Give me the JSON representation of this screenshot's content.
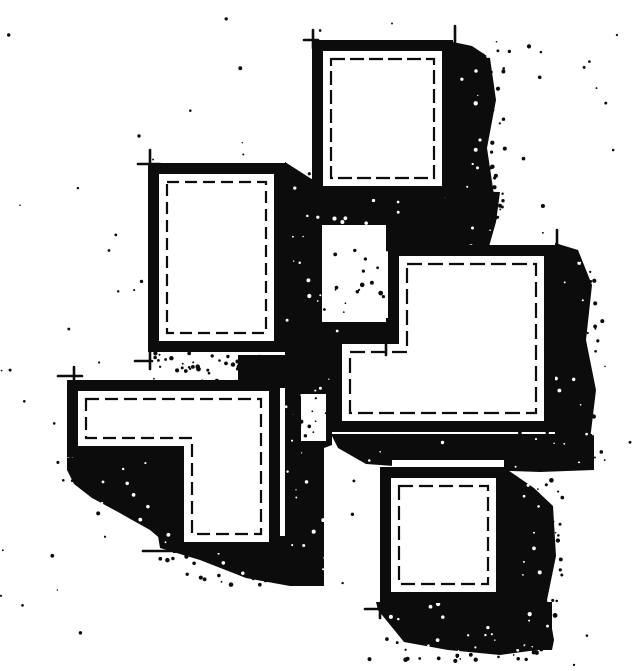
{
  "meta": {
    "description": "Hand-drawn black and white architectural figure-ground sketch: five white rectangular blocks with heavy black outlines, thin broken inner outlines, corner overshoot tick marks, dense black drop shadows cast down and to the right, and stippled dot texture scattered over the paper."
  },
  "canvas": {
    "width": 640,
    "height": 671,
    "paper": "#ffffff",
    "ink": "#0c0c0c"
  },
  "figure": {
    "rooms": [
      {
        "name": "room-top-square",
        "dash": "14 5",
        "outer": [
          [
            312,
            40
          ],
          [
            453,
            40
          ],
          [
            453,
            197
          ],
          [
            312,
            197
          ]
        ],
        "inner": [
          [
            323,
            51
          ],
          [
            442,
            51
          ],
          [
            442,
            186
          ],
          [
            323,
            186
          ]
        ],
        "line": [
          [
            331,
            59
          ],
          [
            434,
            59
          ],
          [
            434,
            178
          ],
          [
            331,
            178
          ]
        ]
      },
      {
        "name": "room-left-rectangle",
        "dash": "12 6",
        "outer": [
          [
            148,
            163
          ],
          [
            285,
            163
          ],
          [
            285,
            352
          ],
          [
            148,
            352
          ]
        ],
        "inner": [
          [
            159,
            174
          ],
          [
            274,
            174
          ],
          [
            274,
            341
          ],
          [
            159,
            341
          ]
        ],
        "line": [
          [
            167,
            182
          ],
          [
            266,
            182
          ],
          [
            266,
            333
          ],
          [
            167,
            333
          ]
        ]
      },
      {
        "name": "room-large-l-block",
        "dash": "15 6",
        "outer": [
          [
            388,
            245
          ],
          [
            555,
            245
          ],
          [
            555,
            432
          ],
          [
            331,
            432
          ],
          [
            331,
            333
          ],
          [
            388,
            333
          ]
        ],
        "inner": [
          [
            399,
            256
          ],
          [
            544,
            256
          ],
          [
            544,
            421
          ],
          [
            342,
            421
          ],
          [
            342,
            344
          ],
          [
            399,
            344
          ]
        ],
        "line": [
          [
            407,
            264
          ],
          [
            536,
            264
          ],
          [
            536,
            413
          ],
          [
            350,
            413
          ],
          [
            350,
            352
          ],
          [
            407,
            352
          ]
        ]
      },
      {
        "name": "room-lower-l-block",
        "dash": "13 6",
        "outer": [
          [
            67,
            380
          ],
          [
            280,
            380
          ],
          [
            280,
            553
          ],
          [
            173,
            553
          ],
          [
            173,
            457
          ],
          [
            67,
            457
          ]
        ],
        "inner": [
          [
            78,
            391
          ],
          [
            269,
            391
          ],
          [
            269,
            542
          ],
          [
            184,
            542
          ],
          [
            184,
            446
          ],
          [
            78,
            446
          ]
        ],
        "line": [
          [
            86,
            399
          ],
          [
            261,
            399
          ],
          [
            261,
            534
          ],
          [
            192,
            534
          ],
          [
            192,
            438
          ],
          [
            86,
            438
          ]
        ]
      },
      {
        "name": "room-bottom-square",
        "dash": "14 6",
        "outer": [
          [
            380,
            467
          ],
          [
            507,
            467
          ],
          [
            507,
            603
          ],
          [
            380,
            603
          ]
        ],
        "inner": [
          [
            391,
            478
          ],
          [
            496,
            478
          ],
          [
            496,
            592
          ],
          [
            391,
            592
          ]
        ],
        "line": [
          [
            399,
            486
          ],
          [
            488,
            486
          ],
          [
            488,
            584
          ],
          [
            399,
            584
          ]
        ]
      }
    ],
    "shadows": [
      {
        "name": "shadow-top-square-right",
        "points": [
          [
            453,
            42
          ],
          [
            472,
            46
          ],
          [
            490,
            58
          ],
          [
            496,
            100
          ],
          [
            487,
            148
          ],
          [
            494,
            195
          ],
          [
            489,
            230
          ],
          [
            468,
            233
          ],
          [
            453,
            222
          ]
        ]
      },
      {
        "name": "shadow-top-square-below",
        "points": [
          [
            288,
            166
          ],
          [
            312,
            182
          ],
          [
            345,
            188
          ],
          [
            500,
            192
          ],
          [
            496,
            222
          ],
          [
            488,
            250
          ],
          [
            330,
            252
          ],
          [
            288,
            250
          ]
        ]
      },
      {
        "name": "shadow-center-column",
        "points": [
          [
            285,
            162
          ],
          [
            310,
            178
          ],
          [
            332,
            190
          ],
          [
            332,
            445
          ],
          [
            324,
            448
          ],
          [
            324,
            538
          ],
          [
            310,
            542
          ],
          [
            285,
            540
          ]
        ]
      },
      {
        "name": "shadow-notch-floor",
        "points": [
          [
            322,
            318
          ],
          [
            389,
            318
          ],
          [
            389,
            336
          ],
          [
            322,
            336
          ]
        ]
      },
      {
        "name": "shadow-left-rect-below",
        "points": [
          [
            238,
            355
          ],
          [
            287,
            355
          ],
          [
            287,
            388
          ],
          [
            238,
            388
          ]
        ]
      },
      {
        "name": "shadow-lower-l-left",
        "points": [
          [
            67,
            456
          ],
          [
            176,
            456
          ],
          [
            176,
            552
          ],
          [
            150,
            530
          ],
          [
            118,
            512
          ],
          [
            92,
            498
          ],
          [
            74,
            484
          ],
          [
            67,
            470
          ]
        ]
      },
      {
        "name": "shadow-lower-l-below",
        "points": [
          [
            158,
            536
          ],
          [
            324,
            536
          ],
          [
            324,
            586
          ],
          [
            290,
            586
          ],
          [
            246,
            578
          ],
          [
            200,
            560
          ],
          [
            160,
            548
          ]
        ]
      },
      {
        "name": "shadow-large-l-right",
        "points": [
          [
            555,
            243
          ],
          [
            578,
            250
          ],
          [
            592,
            285
          ],
          [
            586,
            340
          ],
          [
            596,
            390
          ],
          [
            590,
            440
          ],
          [
            594,
            468
          ],
          [
            555,
            468
          ]
        ]
      },
      {
        "name": "shadow-large-l-below",
        "points": [
          [
            331,
            434
          ],
          [
            594,
            434
          ],
          [
            594,
            470
          ],
          [
            540,
            472
          ],
          [
            480,
            470
          ],
          [
            420,
            468
          ],
          [
            394,
            466
          ],
          [
            366,
            464
          ],
          [
            338,
            448
          ]
        ]
      },
      {
        "name": "shadow-bottom-square-right",
        "points": [
          [
            505,
            468
          ],
          [
            534,
            488
          ],
          [
            553,
            506
          ],
          [
            556,
            556
          ],
          [
            547,
            600
          ],
          [
            554,
            640
          ],
          [
            552,
            650
          ],
          [
            505,
            650
          ]
        ]
      },
      {
        "name": "shadow-bottom-square-below",
        "points": [
          [
            376,
            602
          ],
          [
            552,
            602
          ],
          [
            552,
            648
          ],
          [
            500,
            655
          ],
          [
            448,
            650
          ],
          [
            404,
            642
          ],
          [
            378,
            610
          ]
        ]
      }
    ],
    "white_patches": [
      {
        "name": "gap-notch-courtyard",
        "rect": [
          322,
          225,
          64,
          97
        ]
      },
      {
        "name": "gap-left-of-large-l",
        "rect": [
          301,
          394,
          25,
          47
        ]
      },
      {
        "name": "gap-above-bottom-square",
        "rect": [
          392,
          460,
          112,
          8
        ]
      }
    ],
    "ticks": [
      {
        "from": [
          313,
          30
        ],
        "to": [
          313,
          48
        ]
      },
      {
        "from": [
          304,
          40
        ],
        "to": [
          318,
          40
        ]
      },
      {
        "from": [
          455,
          26
        ],
        "to": [
          455,
          50
        ]
      },
      {
        "from": [
          150,
          150
        ],
        "to": [
          150,
          172
        ]
      },
      {
        "from": [
          138,
          164
        ],
        "to": [
          160,
          164
        ]
      },
      {
        "from": [
          150,
          350
        ],
        "to": [
          150,
          369
        ]
      },
      {
        "from": [
          135,
          361
        ],
        "to": [
          152,
          361
        ]
      },
      {
        "from": [
          557,
          230
        ],
        "to": [
          557,
          252
        ]
      },
      {
        "from": [
          386,
          333
        ],
        "to": [
          386,
          355
        ]
      },
      {
        "from": [
          363,
          338
        ],
        "to": [
          392,
          338
        ]
      },
      {
        "from": [
          74,
          367
        ],
        "to": [
          74,
          390
        ]
      },
      {
        "from": [
          58,
          376
        ],
        "to": [
          82,
          376
        ]
      },
      {
        "from": [
          143,
          551
        ],
        "to": [
          176,
          551
        ]
      },
      {
        "from": [
          365,
          609
        ],
        "to": [
          383,
          609
        ]
      },
      {
        "from": [
          380,
          603
        ],
        "to": [
          380,
          618
        ]
      }
    ],
    "stipple": {
      "seed": 20240601,
      "background_dots": {
        "count": 110,
        "radius": [
          0.7,
          2.1
        ]
      },
      "shadow_speckles": {
        "count": 650,
        "radius": [
          0.6,
          2.2
        ]
      },
      "ragged_bands": [
        {
          "rect": [
            480,
            50,
            26,
            185
          ],
          "count": 30
        },
        {
          "rect": [
            573,
            255,
            30,
            215
          ],
          "count": 36
        },
        {
          "rect": [
            533,
            478,
            30,
            175
          ],
          "count": 30
        },
        {
          "rect": [
            385,
            635,
            170,
            26
          ],
          "count": 32
        },
        {
          "rect": [
            155,
            555,
            165,
            32
          ],
          "count": 34
        },
        {
          "rect": [
            72,
            462,
            108,
            50
          ],
          "count": 30
        },
        {
          "rect": [
            152,
            353,
            135,
            30
          ],
          "count": 50
        },
        {
          "rect": [
            322,
            228,
            62,
            92
          ],
          "count": 16
        },
        {
          "rect": [
            455,
            188,
            52,
            50
          ],
          "count": 16
        },
        {
          "rect": [
            290,
            388,
            45,
            55
          ],
          "count": 14
        }
      ]
    }
  }
}
